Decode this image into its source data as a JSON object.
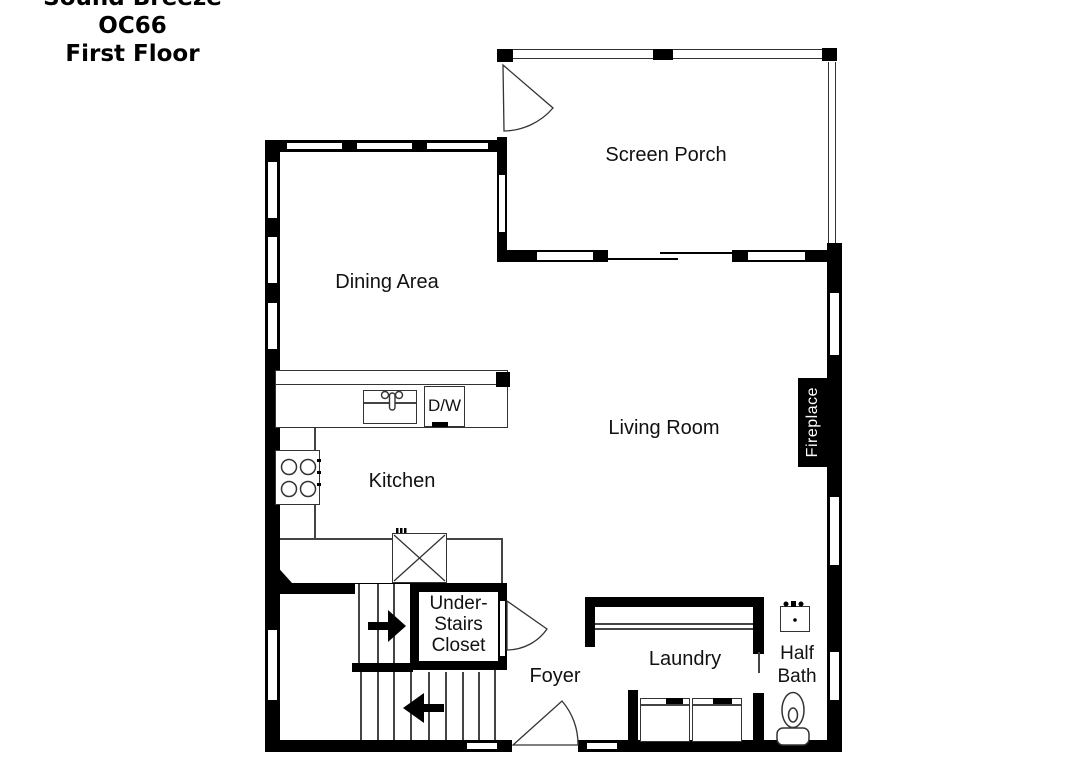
{
  "title": {
    "line1": "Sound Breeze",
    "line2": "OC66",
    "line3": "First Floor"
  },
  "rooms": {
    "screen_porch": "Screen Porch",
    "dining_area": "Dining Area",
    "living_room": "Living Room",
    "kitchen": "Kitchen",
    "under_stairs_closet": "Under-\nStairs\nCloset",
    "foyer": "Foyer",
    "laundry": "Laundry",
    "half_bath": "Half Bath",
    "fireplace": "Fireplace"
  },
  "fixtures": {
    "dishwasher": "D/W"
  },
  "colors": {
    "wall": "#000000",
    "background": "#ffffff",
    "thin_line": "#333333",
    "label": "#111111"
  }
}
